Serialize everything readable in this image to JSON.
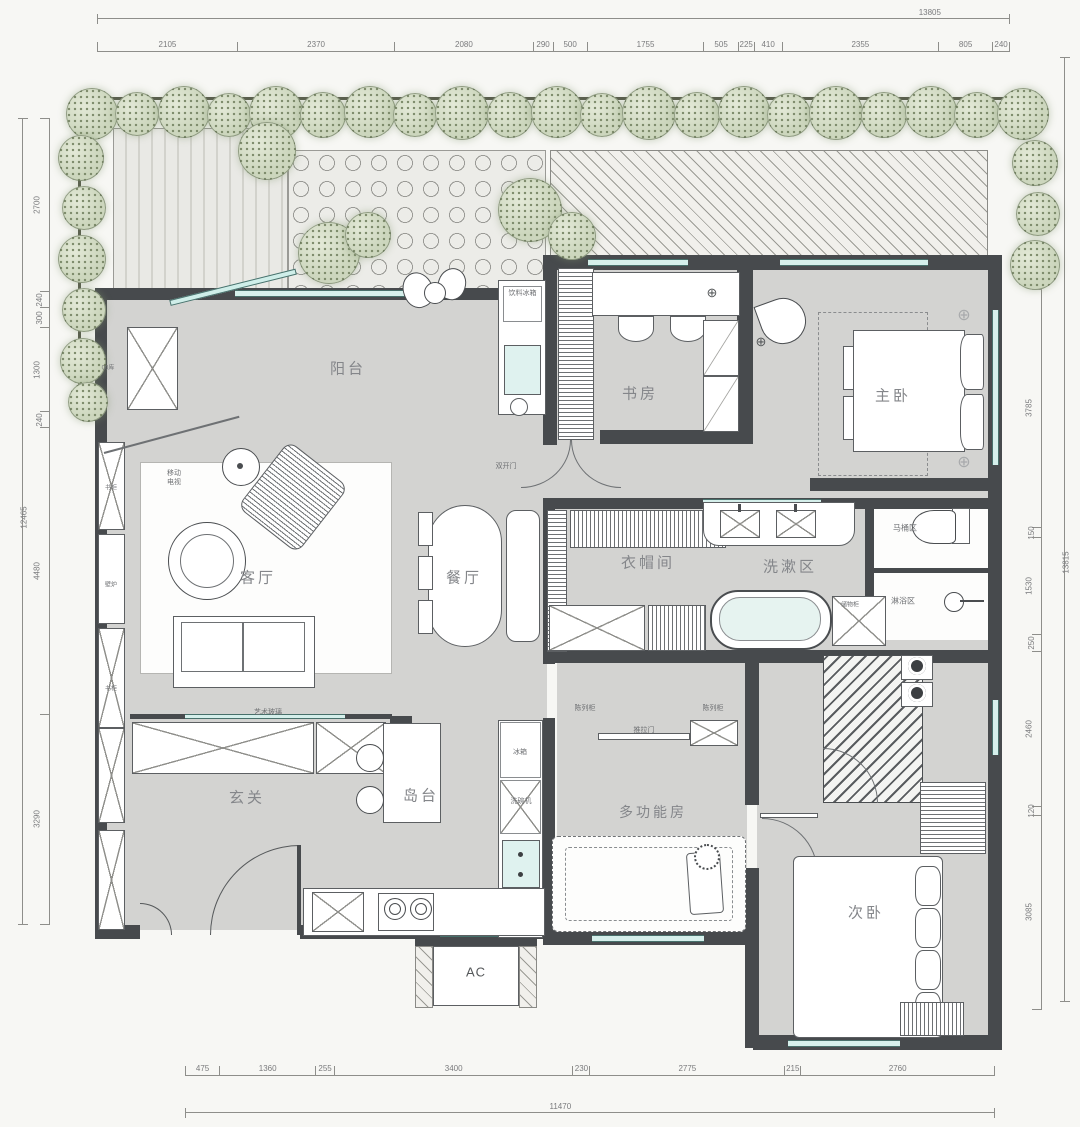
{
  "dimensions": {
    "top": {
      "total": "13805",
      "segments": [
        "2105",
        "2370",
        "2080",
        "290",
        "500",
        "1755",
        "505",
        "225",
        "410",
        "2355",
        "805",
        "240"
      ]
    },
    "bottom": {
      "total": "11470",
      "segments": [
        "475",
        "1360",
        "255",
        "3400",
        "230",
        "2775",
        "215",
        "2760"
      ]
    },
    "left": {
      "total": "12465",
      "segments": [
        "2700",
        "240",
        "300",
        "1300",
        "240",
        "4480",
        "3290"
      ]
    },
    "right": {
      "total": "13815",
      "segments": [
        "240",
        "300",
        "3785",
        "150",
        "1530",
        "250",
        "2460",
        "120",
        "3085"
      ]
    }
  },
  "rooms": {
    "balcony": "阳台",
    "study": "书房",
    "master": "主卧",
    "living": "客厅",
    "dining": "餐厅",
    "closet": "衣帽间",
    "wash": "洗漱区",
    "toilet": "马桶区",
    "shower": "淋浴区",
    "entry": "玄关",
    "island": "岛台",
    "multi": "多功能房",
    "second": "次卧",
    "ac": "AC"
  },
  "annotations": {
    "drink_fridge": "饮料冰箱",
    "mobile_tv": "移动电视",
    "bookcase_top": "书柜",
    "fireplace": "壁炉",
    "bookcase_bottom": "书柜",
    "double_door": "双开门",
    "art_glass": "艺术玻璃",
    "display_left": "陈列柜",
    "display_right": "陈列柜",
    "sliding_door": "推拉门",
    "fridge": "冰箱",
    "dishwasher": "洗碗机",
    "boiler": "锅炉",
    "storage": "储物柜",
    "store_left": "00库"
  },
  "colors": {
    "wall": "#474a4d",
    "floor": "#d3d3d1",
    "window": "#d5efeb",
    "tree": "#ccd6bd"
  }
}
